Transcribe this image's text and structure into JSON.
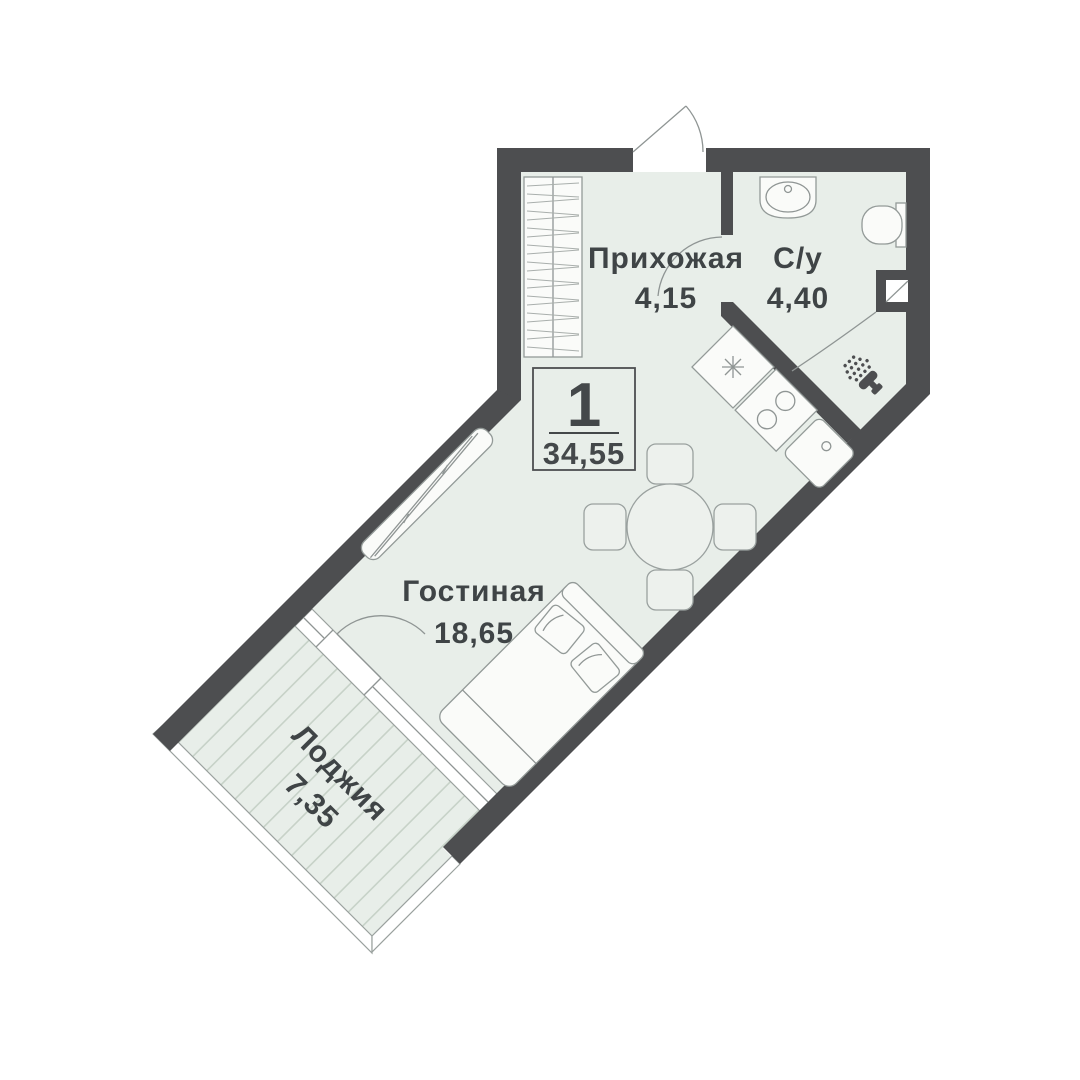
{
  "floorplan": {
    "badge": {
      "room_count": "1",
      "total_area": "34,55"
    },
    "rooms": [
      {
        "name": "Прихожая",
        "area": "4,15"
      },
      {
        "name": "С/у",
        "area": "4,40"
      },
      {
        "name": "Гостиная",
        "area": "18,65"
      },
      {
        "name": "Лоджия",
        "area": "7,35"
      }
    ],
    "colors": {
      "wall": "#4d4e50",
      "floor": "#e8eee9",
      "loggia_stripe": "#c7d2c8",
      "furniture_outline": "#939a98",
      "fixture_fill": "#fafbf9",
      "text": "#3f4446"
    },
    "icons": [
      "entrance-door-arc",
      "wardrobe-hatch",
      "sliding-wardrobe",
      "kitchen-hob-asterisk",
      "kitchen-burners",
      "kitchen-sink",
      "dining-table",
      "chair",
      "bed",
      "pillow",
      "bath-sink",
      "toilet",
      "ventilation-shaft",
      "shower-head-spray",
      "balcony-door-arc",
      "loggia-decking"
    ]
  }
}
